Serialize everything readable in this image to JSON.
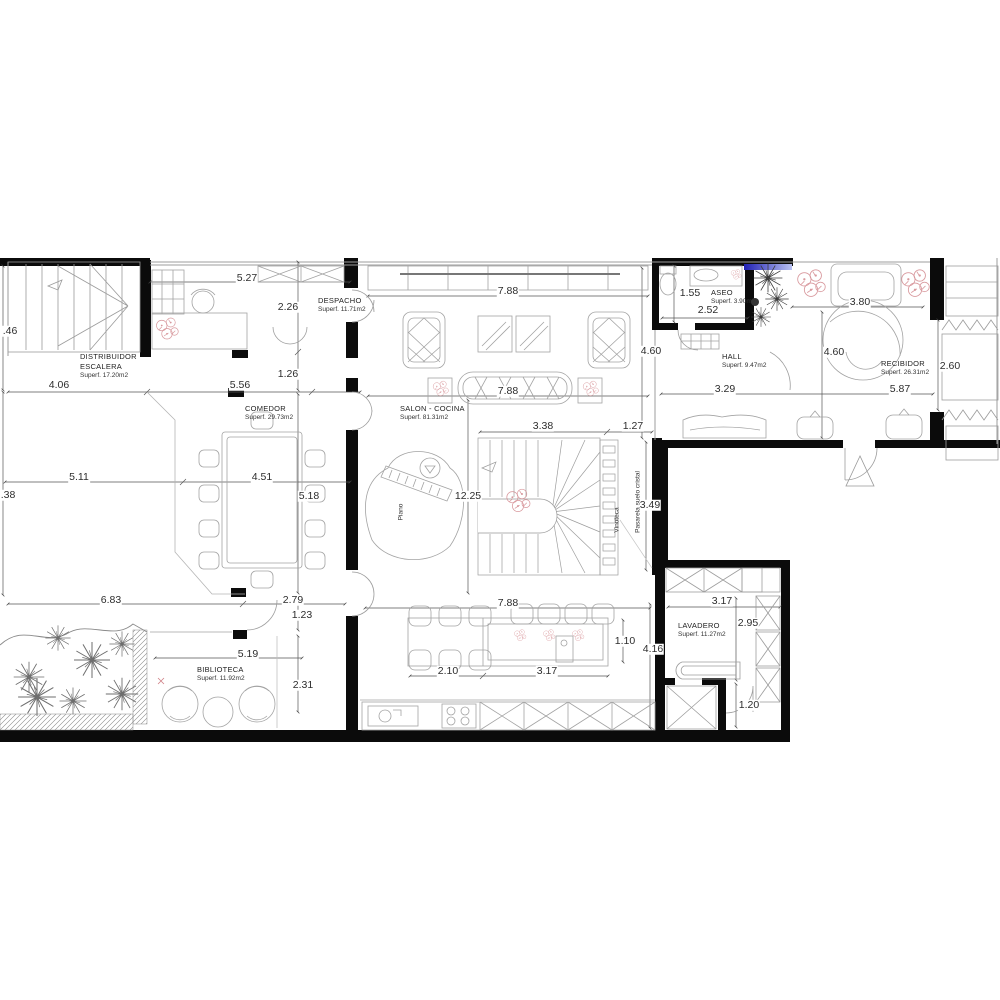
{
  "colors": {
    "wall": "#0b0b0b",
    "furniture": "#a3a3a3",
    "dimension_line": "#555555",
    "text": "#2d2d2d",
    "plant_garden": "#6e6e6e",
    "plant_dark": "#3c3c3c",
    "accent_red": "#cf7f85",
    "glass_bar_start": "#2020b4",
    "glass_bar_end": "#b9c2f2"
  },
  "rooms": [
    {
      "lines": [
        "DISTRIBUIDOR",
        "ESCALERA"
      ],
      "area": "Superf. 17.20m2",
      "x": 80,
      "y": 352
    },
    {
      "lines": [
        "DESPACHO"
      ],
      "area": "Superf. 11.71m2",
      "x": 318,
      "y": 296
    },
    {
      "lines": [
        "COMEDOR"
      ],
      "area": "Superf. 29.73m2",
      "x": 245,
      "y": 404
    },
    {
      "lines": [
        "SALON - COCINA"
      ],
      "area": "Superf. 81.31m2",
      "x": 400,
      "y": 404
    },
    {
      "lines": [
        "ASEO"
      ],
      "area": "Superf. 3.90m2",
      "x": 711,
      "y": 288
    },
    {
      "lines": [
        "HALL"
      ],
      "area": "Superf. 9.47m2",
      "x": 722,
      "y": 352
    },
    {
      "lines": [
        "RECIBIDOR"
      ],
      "area": "Superf. 26.31m2",
      "x": 881,
      "y": 359
    },
    {
      "lines": [
        "LAVADERO"
      ],
      "area": "Superf. 11.27m2",
      "x": 678,
      "y": 621
    },
    {
      "lines": [
        "BIBLIOTECA"
      ],
      "area": "Superf. 11.92m2",
      "x": 197,
      "y": 665
    }
  ],
  "annotations": [
    {
      "text": "Piano",
      "x": 401,
      "y": 512
    },
    {
      "text": "Vinoteca",
      "x": 617,
      "y": 520
    },
    {
      "text": "Pasarela suelo cristal",
      "x": 638,
      "y": 502
    }
  ],
  "dimensions": [
    {
      "text": ".46",
      "x": 10,
      "y": 331
    },
    {
      "text": "5.27",
      "x": 247,
      "y": 278
    },
    {
      "text": "2.26",
      "x": 288,
      "y": 307
    },
    {
      "text": "7.88",
      "x": 508,
      "y": 291
    },
    {
      "text": "1.55",
      "x": 690,
      "y": 293
    },
    {
      "text": "2.52",
      "x": 708,
      "y": 310
    },
    {
      "text": "3.80",
      "x": 860,
      "y": 302
    },
    {
      "text": "4.60",
      "x": 651,
      "y": 351
    },
    {
      "text": "4.60",
      "x": 834,
      "y": 352
    },
    {
      "text": "2.60",
      "x": 950,
      "y": 366
    },
    {
      "text": "1.26",
      "x": 288,
      "y": 374
    },
    {
      "text": "4.06",
      "x": 59,
      "y": 385
    },
    {
      "text": "5.56",
      "x": 240,
      "y": 385
    },
    {
      "text": "3.29",
      "x": 725,
      "y": 389
    },
    {
      "text": "5.87",
      "x": 900,
      "y": 389
    },
    {
      "text": "7.88",
      "x": 508,
      "y": 391
    },
    {
      "text": "3.38",
      "x": 543,
      "y": 426
    },
    {
      "text": "1.27",
      "x": 633,
      "y": 426
    },
    {
      "text": "5.11",
      "x": 79,
      "y": 477
    },
    {
      "text": "4.51",
      "x": 262,
      "y": 477
    },
    {
      "text": "5.18",
      "x": 309,
      "y": 496
    },
    {
      "text": "12.25",
      "x": 468,
      "y": 496
    },
    {
      "text": "3.49",
      "x": 650,
      "y": 505
    },
    {
      "text": ".38",
      "x": 8,
      "y": 495
    },
    {
      "text": "6.83",
      "x": 111,
      "y": 600
    },
    {
      "text": "2.79",
      "x": 293,
      "y": 600
    },
    {
      "text": "1.23",
      "x": 302,
      "y": 615
    },
    {
      "text": "7.88",
      "x": 508,
      "y": 603
    },
    {
      "text": "3.17",
      "x": 722,
      "y": 601
    },
    {
      "text": "5.19",
      "x": 248,
      "y": 654
    },
    {
      "text": "2.95",
      "x": 748,
      "y": 623
    },
    {
      "text": "2.31",
      "x": 303,
      "y": 685
    },
    {
      "text": "1.10",
      "x": 625,
      "y": 641
    },
    {
      "text": "4.16",
      "x": 653,
      "y": 649
    },
    {
      "text": "2.10",
      "x": 448,
      "y": 671
    },
    {
      "text": "3.17",
      "x": 547,
      "y": 671
    },
    {
      "text": "1.20",
      "x": 749,
      "y": 705
    }
  ]
}
